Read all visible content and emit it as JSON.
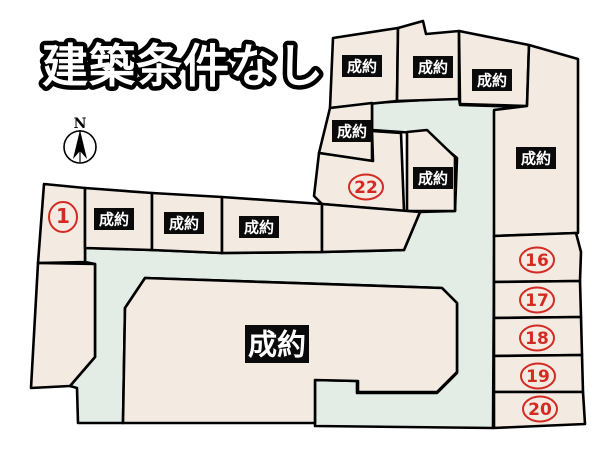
{
  "title": "建築条件なし",
  "compass": {
    "label": "N"
  },
  "legend": {
    "sold_label": "成約"
  },
  "colors": {
    "background": "#ffffff",
    "lot_fill": "#f3eae1",
    "road_fill": "#e4ece6",
    "line": "#000000",
    "sold_badge_bg": "#0a0a0a",
    "sold_badge_text": "#ffffff",
    "number_red": "#d42a24"
  },
  "map": {
    "road_points": [
      [
        372,
        103
      ],
      [
        459,
        98
      ],
      [
        460,
        105
      ],
      [
        527,
        107
      ],
      [
        495,
        110
      ],
      [
        493,
        428
      ],
      [
        315,
        426
      ],
      [
        315,
        380
      ],
      [
        357,
        381
      ],
      [
        357,
        393
      ],
      [
        437,
        393
      ],
      [
        457,
        373
      ],
      [
        457,
        303
      ],
      [
        442,
        288
      ],
      [
        145,
        278
      ],
      [
        125,
        308
      ],
      [
        123,
        423
      ],
      [
        78,
        423
      ],
      [
        77,
        388
      ],
      [
        70,
        386
      ],
      [
        95,
        357
      ],
      [
        95,
        264
      ],
      [
        85,
        262
      ],
      [
        85,
        248
      ],
      [
        152,
        250
      ],
      [
        222,
        253
      ],
      [
        322,
        252
      ],
      [
        404,
        250
      ],
      [
        420,
        212
      ],
      [
        455,
        211
      ],
      [
        457,
        158
      ],
      [
        428,
        134
      ],
      [
        401,
        132
      ],
      [
        372,
        130
      ]
    ],
    "lots": [
      {
        "name": "lot-north-a",
        "type": "sold",
        "label": "成約",
        "pos": [
          362,
          66
        ],
        "points": [
          [
            333,
            38
          ],
          [
            398,
            28
          ],
          [
            397,
            101
          ],
          [
            330,
            108
          ]
        ]
      },
      {
        "name": "lot-north-b",
        "type": "sold",
        "label": "成約",
        "pos": [
          433,
          67
        ],
        "points": [
          [
            398,
            28
          ],
          [
            423,
            21
          ],
          [
            426,
            34
          ],
          [
            459,
            31
          ],
          [
            459,
            99
          ],
          [
            397,
            101
          ]
        ]
      },
      {
        "name": "lot-north-c",
        "type": "sold",
        "label": "成約",
        "pos": [
          492,
          80
        ],
        "points": [
          [
            459,
            31
          ],
          [
            529,
            45
          ],
          [
            527,
            106
          ],
          [
            460,
            104
          ]
        ]
      },
      {
        "name": "lot-east-large",
        "type": "sold",
        "label": "成約",
        "pos": [
          536,
          158
        ],
        "points": [
          [
            529,
            45
          ],
          [
            578,
            59
          ],
          [
            578,
            233
          ],
          [
            494,
            236
          ],
          [
            494,
            110
          ],
          [
            527,
            106
          ]
        ]
      },
      {
        "name": "lot-mid-upper",
        "type": "sold",
        "label": "成約",
        "pos": [
          352,
          131
        ],
        "points": [
          [
            330,
            108
          ],
          [
            372,
            103
          ],
          [
            372,
            161
          ],
          [
            319,
            153
          ]
        ]
      },
      {
        "name": "lot-22",
        "type": "numbered",
        "number": "22",
        "pos": [
          366,
          187
        ],
        "points": [
          [
            372,
            131
          ],
          [
            401,
            133
          ],
          [
            404,
            211
          ],
          [
            322,
            204
          ],
          [
            314,
            196
          ],
          [
            319,
            153
          ],
          [
            373,
            161
          ]
        ]
      },
      {
        "name": "lot-mid-east",
        "type": "sold",
        "label": "成約",
        "pos": [
          433,
          178
        ],
        "points": [
          [
            407,
            132
          ],
          [
            427,
            130
          ],
          [
            455,
            157
          ],
          [
            455,
            211
          ],
          [
            407,
            211
          ]
        ]
      },
      {
        "name": "lot-1",
        "type": "numbered",
        "number": "1",
        "pos": [
          63,
          217
        ],
        "points": [
          [
            44,
            184
          ],
          [
            85,
            188
          ],
          [
            85,
            262
          ],
          [
            38,
            263
          ]
        ]
      },
      {
        "name": "lot-row-a",
        "type": "sold",
        "label": "成約",
        "pos": [
          114,
          219
        ],
        "points": [
          [
            85,
            188
          ],
          [
            152,
            193
          ],
          [
            152,
            250
          ],
          [
            85,
            248
          ]
        ]
      },
      {
        "name": "lot-row-b",
        "type": "sold",
        "label": "成約",
        "pos": [
          184,
          223
        ],
        "points": [
          [
            152,
            193
          ],
          [
            222,
            197
          ],
          [
            222,
            253
          ],
          [
            152,
            250
          ]
        ]
      },
      {
        "name": "lot-row-c",
        "type": "sold",
        "label": "成約",
        "pos": [
          259,
          227
        ],
        "points": [
          [
            222,
            197
          ],
          [
            322,
            204
          ],
          [
            322,
            252
          ],
          [
            222,
            253
          ]
        ]
      },
      {
        "name": "lot-row-d",
        "type": "unlabeled",
        "points": [
          [
            322,
            204
          ],
          [
            420,
            212
          ],
          [
            404,
            250
          ],
          [
            322,
            252
          ]
        ]
      },
      {
        "name": "lot-west-wedge",
        "type": "unlabeled",
        "points": [
          [
            38,
            263
          ],
          [
            95,
            264
          ],
          [
            95,
            357
          ],
          [
            70,
            386
          ],
          [
            31,
            388
          ]
        ]
      },
      {
        "name": "lot-central-large",
        "type": "sold",
        "label": "成約",
        "size": "large",
        "pos": [
          277,
          344
        ],
        "points": [
          [
            145,
            278
          ],
          [
            442,
            288
          ],
          [
            457,
            303
          ],
          [
            457,
            372
          ],
          [
            437,
            392
          ],
          [
            358,
            392
          ],
          [
            358,
            381
          ],
          [
            315,
            380
          ],
          [
            315,
            423
          ],
          [
            123,
            423
          ],
          [
            125,
            308
          ]
        ]
      },
      {
        "name": "lot-16",
        "type": "numbered",
        "number": "16",
        "pos": [
          537,
          260
        ],
        "points": [
          [
            494,
            236
          ],
          [
            576,
            233
          ],
          [
            581,
            252
          ],
          [
            580,
            281
          ],
          [
            494,
            282
          ]
        ]
      },
      {
        "name": "lot-17",
        "type": "numbered",
        "number": "17",
        "pos": [
          537,
          300
        ],
        "points": [
          [
            494,
            282
          ],
          [
            580,
            281
          ],
          [
            581,
            317
          ],
          [
            494,
            318
          ]
        ]
      },
      {
        "name": "lot-18",
        "type": "numbered",
        "number": "18",
        "pos": [
          537,
          338
        ],
        "points": [
          [
            494,
            318
          ],
          [
            581,
            317
          ],
          [
            582,
            355
          ],
          [
            494,
            356
          ]
        ]
      },
      {
        "name": "lot-19",
        "type": "numbered",
        "number": "19",
        "pos": [
          538,
          376
        ],
        "points": [
          [
            494,
            356
          ],
          [
            582,
            355
          ],
          [
            583,
            392
          ],
          [
            494,
            392
          ]
        ]
      },
      {
        "name": "lot-20",
        "type": "numbered",
        "number": "20",
        "pos": [
          540,
          409
        ],
        "points": [
          [
            494,
            392
          ],
          [
            583,
            392
          ],
          [
            585,
            424
          ],
          [
            494,
            428
          ]
        ]
      }
    ]
  }
}
